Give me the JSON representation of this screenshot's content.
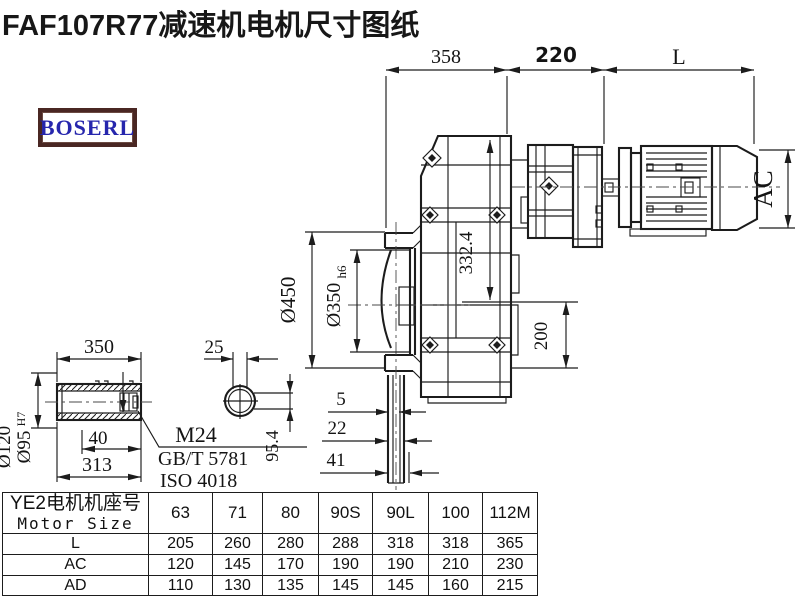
{
  "title": "FAF107R77减速机电机尺寸图纸",
  "logo": {
    "text": "BOSERL"
  },
  "drawing": {
    "d358": "358",
    "d220": "220",
    "dL": "L",
    "dia450": "Ø450",
    "dia350": "Ø350",
    "dia350_tol": "h6",
    "d3324": "332.4",
    "d200": "200",
    "dAC": "AC",
    "d5": "5",
    "d22": "22",
    "d41": "41",
    "detail": {
      "d350": "350",
      "d25": "25",
      "d40": "40",
      "d313": "313",
      "dia120": "Ø120",
      "dia95": "Ø95",
      "dia95_tol": "H7",
      "d954": "95.4",
      "callout1": "M24",
      "callout2": "GB/T 5781",
      "callout3": "ISO 4018"
    }
  },
  "table": {
    "header_line1": "YE2电机机座号",
    "header_line2": "Motor Size",
    "sizes": [
      "63",
      "71",
      "80",
      "90S",
      "90L",
      "100",
      "112M"
    ],
    "rows": [
      {
        "label": "L",
        "values": [
          "205",
          "260",
          "280",
          "288",
          "318",
          "318",
          "365"
        ]
      },
      {
        "label": "AC",
        "values": [
          "120",
          "145",
          "170",
          "190",
          "190",
          "210",
          "230"
        ]
      },
      {
        "label": "AD",
        "values": [
          "110",
          "130",
          "135",
          "145",
          "145",
          "160",
          "215"
        ]
      }
    ]
  }
}
